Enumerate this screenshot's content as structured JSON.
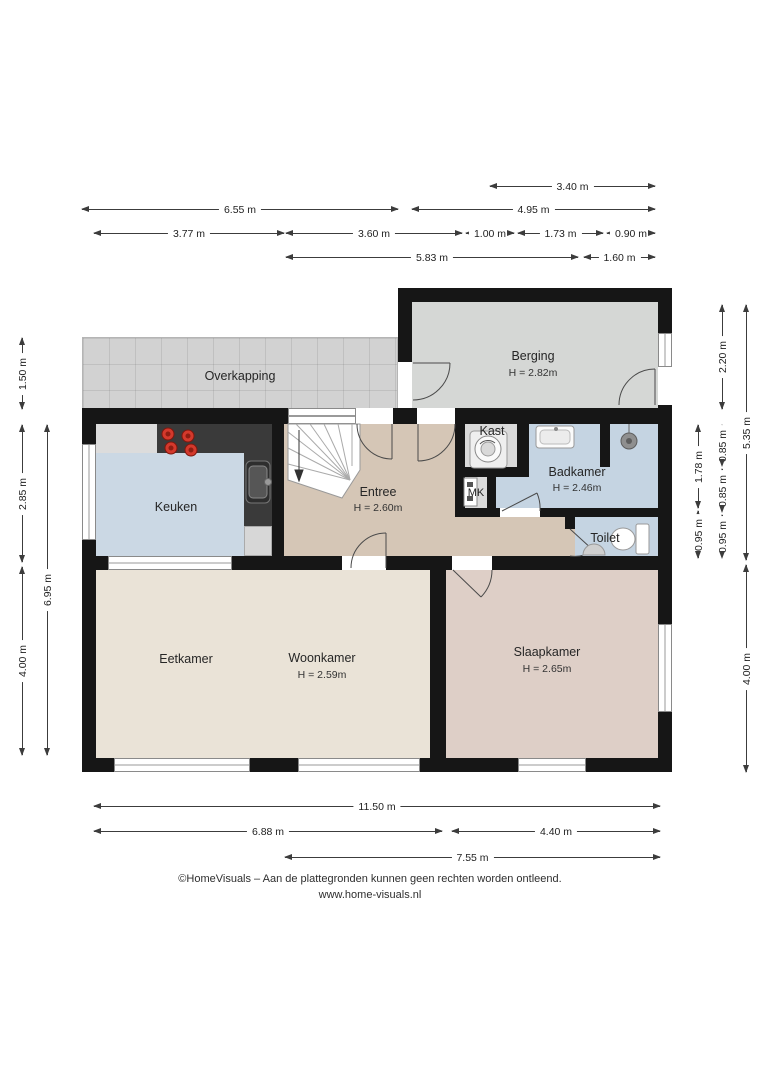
{
  "document": {
    "type": "floor-plan",
    "language": "nl"
  },
  "rooms": {
    "overkapping": {
      "name": "Overkapping"
    },
    "berging": {
      "name": "Berging",
      "height": "H = 2.82m"
    },
    "keuken": {
      "name": "Keuken"
    },
    "entree": {
      "name": "Entree",
      "height": "H = 2.60m"
    },
    "kast": {
      "name": "Kast"
    },
    "mk": {
      "name": "MK"
    },
    "badkamer": {
      "name": "Badkamer",
      "height": "H = 2.46m"
    },
    "toilet": {
      "name": "Toilet"
    },
    "eetkamer": {
      "name": "Eetkamer"
    },
    "woonkamer": {
      "name": "Woonkamer",
      "height": "H = 2.59m"
    },
    "slaapkamer": {
      "name": "Slaapkamer",
      "height": "H = 2.65m"
    }
  },
  "dims": {
    "t1": "3.40 m",
    "t2": "6.55 m",
    "t3": "4.95 m",
    "t4": "3.77 m",
    "t5": "3.60 m",
    "t6": "1.00 m",
    "t7": "1.73 m",
    "t8": "0.90 m",
    "t9": "5.83 m",
    "t10": "1.60 m",
    "l1": "1.50 m",
    "l2": "2.85 m",
    "l3": "4.00 m",
    "l4": "6.95 m",
    "r1": "2.20 m",
    "r2": "5.35 m",
    "r3": "1.78 m",
    "r4": "0.85 m",
    "r5": "0.85 m",
    "r6": "0.95 m",
    "r7": "0.95 m",
    "r8": "4.00 m",
    "b1": "11.50 m",
    "b2": "6.88 m",
    "b3": "4.40 m",
    "b4": "7.55 m"
  },
  "footer": {
    "line1": "©HomeVisuals – Aan de plattegronden kunnen geen rechten worden ontleend.",
    "line2": "www.home-visuals.nl"
  },
  "icons": [
    "staircase",
    "washing-machine",
    "cooktop",
    "kitchen-sink",
    "washbasin",
    "shower-drain",
    "toilet",
    "fountain-sink",
    "meter-box",
    "door-swing"
  ],
  "colors": {
    "wall": "#161616",
    "overkapping_floor": "#d2d2d2",
    "berging_floor": "#d5d7d5",
    "keuken_floor": "#cbd8e4",
    "entree_floor": "#d5c6b6",
    "kast_floor": "#dadada",
    "badkamer_floor": "#c5d4e2",
    "living_floor": "#eae3d7",
    "slaapkamer_floor": "#decfc7",
    "counter": "#3a3a3a",
    "cooktop_burner": "#d3392c"
  }
}
